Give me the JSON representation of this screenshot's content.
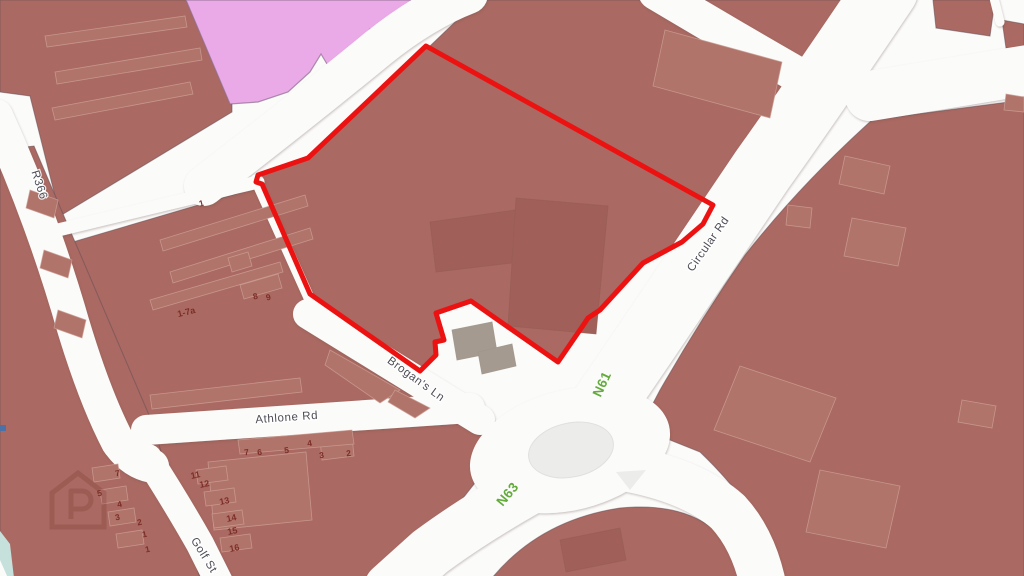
{
  "map": {
    "description": "street map with red property boundary",
    "palette": {
      "block": "#aa6962",
      "building": "#b1746b",
      "building_dark": "#a05f58",
      "building_gray": "#a49a90",
      "pink_zone": "#eaa9e7",
      "road_white": "#fbfbfa",
      "roundabout_gray": "#ececea",
      "boundary_red": "#ec1212",
      "route_green": "#64aa3c",
      "road_label_gray": "#4d4c55",
      "house_number_maroon": "#7c2f28",
      "water_teal": "#c6e0dc"
    },
    "road_labels": [
      {
        "name": "road-label-r366",
        "text": "R366",
        "x": 36,
        "y": 186,
        "rot": 72,
        "cls": "road-label"
      },
      {
        "name": "road-label-athlone-rd",
        "text": "Athlone Rd",
        "x": 287,
        "y": 421,
        "rot": -4,
        "cls": "road-label"
      },
      {
        "name": "road-label-brogans-ln",
        "text": "Brogan's Ln",
        "x": 414,
        "y": 382,
        "rot": 36,
        "cls": "road-label"
      },
      {
        "name": "road-label-circular-rd",
        "text": "Circular Rd",
        "x": 711,
        "y": 246,
        "rot": -55,
        "cls": "road-label"
      },
      {
        "name": "road-label-golf-st",
        "text": "Golf St",
        "x": 201,
        "y": 557,
        "rot": 58,
        "cls": "road-label"
      }
    ],
    "route_labels": [
      {
        "name": "route-label-n61",
        "text": "N61",
        "x": 606,
        "y": 386,
        "rot": -65,
        "cls": "route-label"
      },
      {
        "name": "route-label-n63",
        "text": "N63",
        "x": 511,
        "y": 497,
        "rot": -50,
        "cls": "route-label"
      }
    ],
    "house_numbers": [
      {
        "name": "house-number",
        "text": "1",
        "x": 202,
        "y": 206,
        "rot": -14,
        "cls": "house-number"
      },
      {
        "name": "house-number",
        "text": "1-7a",
        "x": 187,
        "y": 315,
        "rot": -14,
        "cls": "house-number-wide"
      },
      {
        "name": "house-number",
        "text": "8",
        "x": 256,
        "y": 299,
        "rot": -14,
        "cls": "house-number"
      },
      {
        "name": "house-number",
        "text": "9",
        "x": 269,
        "y": 300,
        "rot": -14,
        "cls": "house-number"
      },
      {
        "name": "house-number",
        "text": "7",
        "x": 247,
        "y": 455,
        "rot": -8,
        "cls": "house-number"
      },
      {
        "name": "house-number",
        "text": "6",
        "x": 260,
        "y": 455,
        "rot": -8,
        "cls": "house-number"
      },
      {
        "name": "house-number",
        "text": "5",
        "x": 287,
        "y": 453,
        "rot": -8,
        "cls": "house-number"
      },
      {
        "name": "house-number",
        "text": "4",
        "x": 310,
        "y": 446,
        "rot": -8,
        "cls": "house-number"
      },
      {
        "name": "house-number",
        "text": "3",
        "x": 322,
        "y": 458,
        "rot": -8,
        "cls": "house-number"
      },
      {
        "name": "house-number",
        "text": "2",
        "x": 349,
        "y": 456,
        "rot": -8,
        "cls": "house-number"
      },
      {
        "name": "house-number",
        "text": "7",
        "x": 118,
        "y": 476,
        "rot": -12,
        "cls": "house-number"
      },
      {
        "name": "house-number",
        "text": "5",
        "x": 100,
        "y": 496,
        "rot": -12,
        "cls": "house-number"
      },
      {
        "name": "house-number",
        "text": "4",
        "x": 120,
        "y": 507,
        "rot": -12,
        "cls": "house-number"
      },
      {
        "name": "house-number",
        "text": "3",
        "x": 118,
        "y": 520,
        "rot": -12,
        "cls": "house-number"
      },
      {
        "name": "house-number",
        "text": "2",
        "x": 140,
        "y": 525,
        "rot": -12,
        "cls": "house-number"
      },
      {
        "name": "house-number",
        "text": "1",
        "x": 145,
        "y": 537,
        "rot": -12,
        "cls": "house-number"
      },
      {
        "name": "house-number",
        "text": "1",
        "x": 148,
        "y": 552,
        "rot": -12,
        "cls": "house-number"
      },
      {
        "name": "house-number",
        "text": "11",
        "x": 196,
        "y": 478,
        "rot": -12,
        "cls": "house-number-wide"
      },
      {
        "name": "house-number",
        "text": "12",
        "x": 205,
        "y": 487,
        "rot": -12,
        "cls": "house-number-wide"
      },
      {
        "name": "house-number",
        "text": "13",
        "x": 225,
        "y": 504,
        "rot": -12,
        "cls": "house-number-wide"
      },
      {
        "name": "house-number",
        "text": "14",
        "x": 232,
        "y": 521,
        "rot": -12,
        "cls": "house-number-wide"
      },
      {
        "name": "house-number",
        "text": "15",
        "x": 233,
        "y": 534,
        "rot": -12,
        "cls": "house-number-wide"
      },
      {
        "name": "house-number",
        "text": "16",
        "x": 235,
        "y": 551,
        "rot": -12,
        "cls": "house-number-wide"
      }
    ]
  }
}
